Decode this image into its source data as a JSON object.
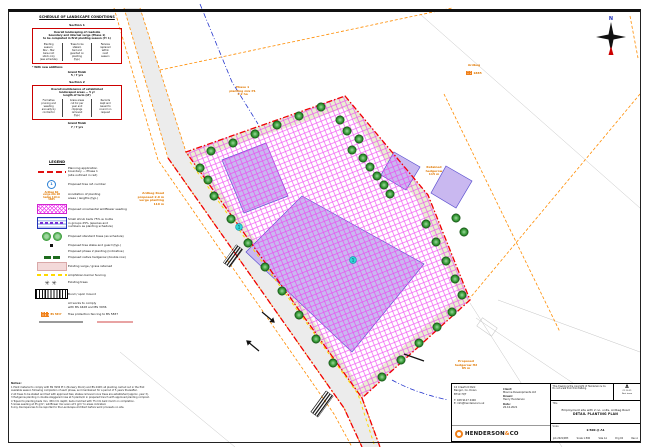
{
  "sheet": {
    "heading": "SCHEDULE OF LANDSCAPE CONDITIONS"
  },
  "tables": {
    "section1": {
      "label": "Section 1",
      "header": "Overall landscaping of roadside\nboundary and internal verge (Phase 1)\nto be completed in first planting season (Yr 1)",
      "cols": [
        "Planting\nseason:\nNov – Mar\nbare-root\nstock only\n(see schedule)",
        "Trees to be\nstaked,\ntied and\nguarded on\nplanting\n(typ.)",
        "Failures\nreplaced\nwithin\nnext\nseason"
      ],
      "footnote": "* With new additions",
      "total": "Grand finish\n5 / 7 yrs"
    },
    "section2": {
      "label": "Section 2",
      "header": "Overall maintenance of established\nlandscaped areas — 5 yr\nlength of term (LT)",
      "cols": [
        "Formative\npruning and\nweeding\nannually by\ncontractor",
        "Grass areas\ncut 6× per\nyear and\nclippings\nremoved\n(typ.)",
        "Records\nkept and\nissued to\ncouncil on\nrequest"
      ],
      "total": "Grand finish\n7 / 7 yrs"
    }
  },
  "legend": {
    "title": "LEGEND",
    "items": [
      {
        "label": "Planning application\nboundary — Phase 1\n(site outlined in red)"
      },
      {
        "label": "Proposed tree ref. number"
      },
      {
        "sample": "Ardbeg Rd\nverge mix 2B\nhedge 110 m\n1885",
        "label": "Annotation of planting\nareas / lengths (typ.)"
      },
      {
        "label": "Proposed ornamental wildflower seeding"
      },
      {
        "label": "Small shrub beds 75% w. bulbs\nin groups 25% (species and\nnumbers as planting schedule)"
      },
      {
        "label": "Proposed standard trees (as schedule)"
      },
      {
        "label": "Proposed tree stake and guard (typ.)"
      },
      {
        "label": "Proposed phase 2 planting (indicative)"
      },
      {
        "label": "Proposed native hedgerow (double row)"
      },
      {
        "label": "Existing verge / grass retained"
      },
      {
        "label": "Amphibian barrier fencing"
      },
      {
        "label": "Existing trees"
      },
      {
        "label": "Bund / spoil mound"
      },
      {
        "label": "All works to comply\nwith BS 4428 and BS 3936"
      },
      {
        "icon_text": "BS 5837",
        "label": "Tree protection fencing to BS 5837"
      }
    ]
  },
  "plan": {
    "north_label": "N",
    "tags": [
      "1",
      "1"
    ],
    "labels": {
      "phase": "Phase 1\nplanting mix P1\n1.2 ha",
      "road": "Ardbeg Road\nproposed 2.0 m\nverge planting\n110 m",
      "hedge_right": "Retained\nhedgerow\n115 m",
      "field": {
        "line1": "Ardbeg",
        "line2": "1885"
      },
      "hedge_bottom": "Proposed\nhedgerow H2\n85 m"
    }
  },
  "notes": {
    "title": "Notes:",
    "lines": [
      "1  Plant material to comply with BS 3936 Pt 1 (Nursery Stock) and BS 4428; all planting carried out in the first",
      "    available season following completion of each phase, and maintained for a period of 5 years thereafter.",
      "2  All trees to be staked and tied with approved ties; stakes removed once trees are established (approx. year 3).",
      "3  Hedgerow planting in double staggered rows at 5 plants/m in prepared trench with approved planting compost.",
      "4  Topsoil to planting beds min. 450 mm depth; beds mulched with 75 mm bark mulch on completion.",
      "5  Grass seeding at 35 g/m²; wildflower mix sown at 5 g/m² to areas indicated.",
      "6  Any discrepancies to be reported to the Landscape Architect before work proceeds on site."
    ]
  },
  "title_block": {
    "company": {
      "address": "10 Crawford Park\nBangor, Co. Down\nBT19 7QT",
      "contact": "T: 028 9127 4400\nE: info@hendersonco.uk",
      "brand": "HENDERSON",
      "brand_amp": "&",
      "brand_co": "CO"
    },
    "fields": {
      "client_label": "Client:",
      "client": "Mourne Developments Ltd",
      "drawn_label": "Drawn:",
      "drawn": "Henry Henderson",
      "date_label": "Date:",
      "date": "20.10.2021"
    },
    "note": "This drawing is the copyright of Henderson & Co.\nDo not scale from this drawing.",
    "revision": {
      "letter": "A",
      "lines": "21.10.21\nFirst issue"
    },
    "title_label": "Title",
    "title1": "Employment site with 2 no. units, Ardbeg Road",
    "title2": "DETAIL PLANTING PLAN",
    "scale_label": "Scale",
    "scale_value": "1:500 @ A1",
    "meta": [
      "Job 2021/083",
      "Scale 1:500",
      "Size A1",
      "Drg 02",
      "Rev A"
    ]
  }
}
